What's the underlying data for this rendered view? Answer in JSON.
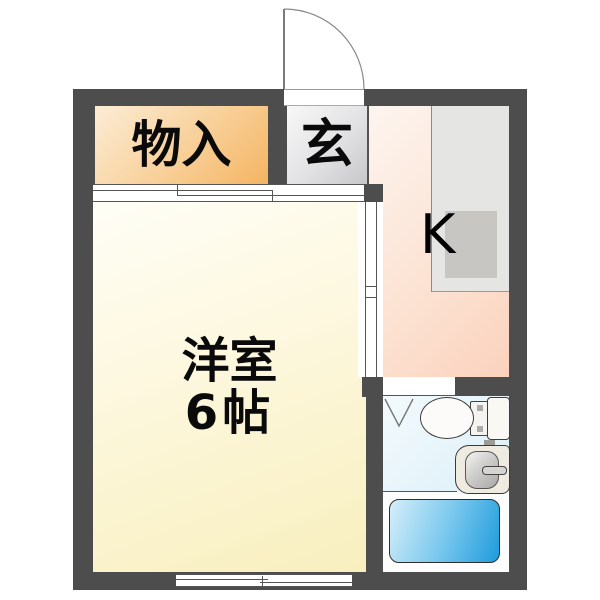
{
  "page": {
    "title": "1K apartment floor plan"
  },
  "rooms": {
    "closet": {
      "label": "物入"
    },
    "entrance": {
      "label": "玄"
    },
    "kitchen": {
      "label": "K"
    },
    "western_room": {
      "name": "洋室",
      "size": "6帖"
    }
  },
  "colors": {
    "wall": "#4d4d4d",
    "closet": "#f4b461",
    "entrance": "#c7c7c9",
    "kitchen": "#fbd2bd",
    "western_room": "#f8efbe",
    "wash_room": "#e2f2f9",
    "bathtub_blue": "#1e9bdc",
    "counter": "#e5e5e3",
    "counter_sink": "#c7c6c3"
  }
}
